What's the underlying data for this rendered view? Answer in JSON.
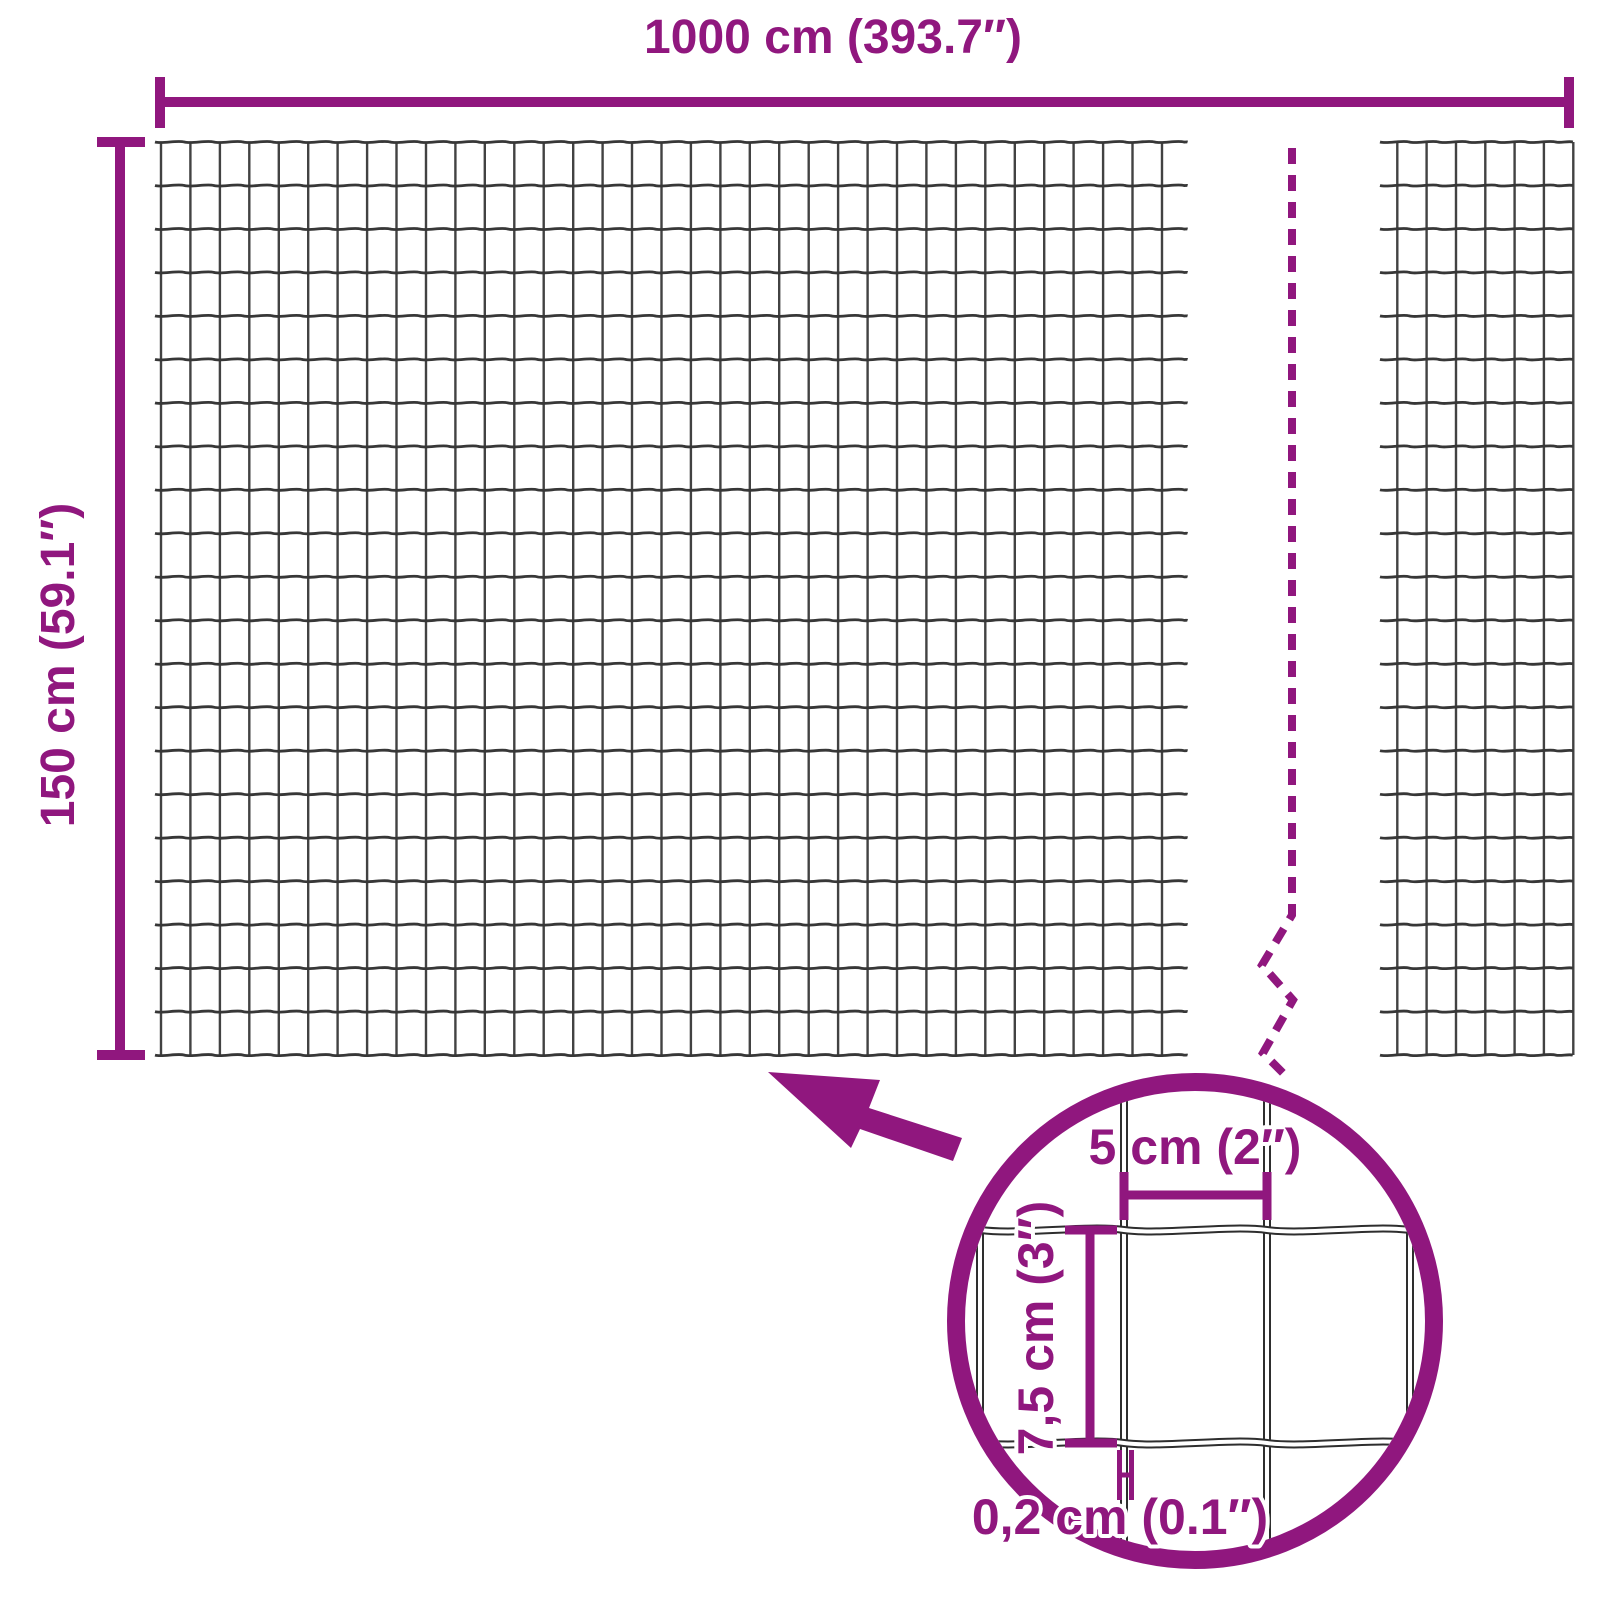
{
  "panel": {
    "width_label": "1000 cm (393.7″)",
    "height_label": "150 cm (59.1″)"
  },
  "magnifier_detail": {
    "mesh_opening_width_label": "5 cm (2″)",
    "mesh_opening_height_label": "7,5 cm (3″)",
    "wire_thickness_label": "0,2 cm (0.1″)"
  },
  "colors": {
    "accent": "#90177E",
    "wire": "#424242",
    "wire_dark": "#373737",
    "detail_wire_outline": "#2E2E2E",
    "background": "#FFFFFF"
  }
}
